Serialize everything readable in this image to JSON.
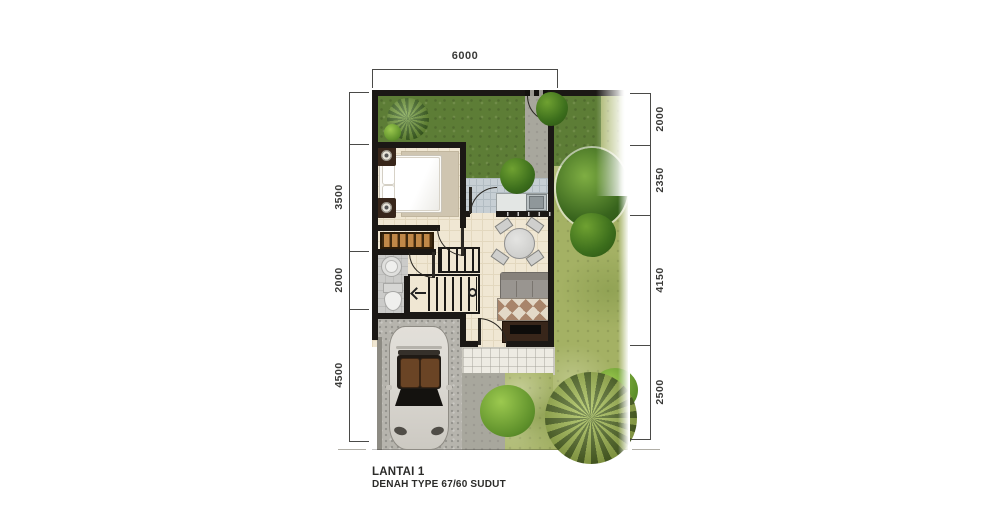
{
  "title": {
    "line1": "LANTAI 1",
    "line2": "DENAH TYPE 67/60 SUDUT"
  },
  "dimensions": {
    "top": [
      {
        "label": "6000"
      }
    ],
    "left": [
      {
        "label": "3500"
      },
      {
        "label": "2000"
      },
      {
        "label": "4500"
      }
    ],
    "right": [
      {
        "label": "2000"
      },
      {
        "label": "2350"
      },
      {
        "label": "4150"
      },
      {
        "label": "2500"
      }
    ]
  },
  "plan": {
    "drawing": "floor-plan",
    "floor": "Lantai 1",
    "house_type": "Type 67/60 Sudut",
    "elements": [
      "front-yard",
      "side-garden",
      "gate",
      "garden-path",
      "patio",
      "kitchen-counter",
      "kitchen-sink",
      "bedroom",
      "bed",
      "nightstand",
      "wardrobe",
      "bathroom",
      "toilet",
      "wash-basin",
      "stairs",
      "dining-table",
      "dining-chairs",
      "sofa",
      "rug",
      "tv-cabinet",
      "front-door",
      "terrace",
      "walkway",
      "carport",
      "car",
      "trees",
      "shrubs"
    ]
  },
  "colors": {
    "wall": "#1b1815",
    "dimline": "#4a4a48",
    "text": "#3a3a38",
    "grassDark": "#5d7d36",
    "grassLight": "#a4b164",
    "treeDark": "#3c661b",
    "treeLight": "#6f9c33",
    "palm": "#a2bd49",
    "floor": "#f0e7d3",
    "floorLine": "#e3d8bf",
    "patio": "#c7cfd4",
    "patioLine": "#b2bcc2",
    "path": "#a8a79d",
    "carport": "#b6b4ad",
    "terrace": "#edebe3",
    "bath": "#cbcbc9",
    "woodDark": "#38261a",
    "wardrobe": "#c08848",
    "sofa": "#999590",
    "carBody": "#dcd9d3"
  }
}
